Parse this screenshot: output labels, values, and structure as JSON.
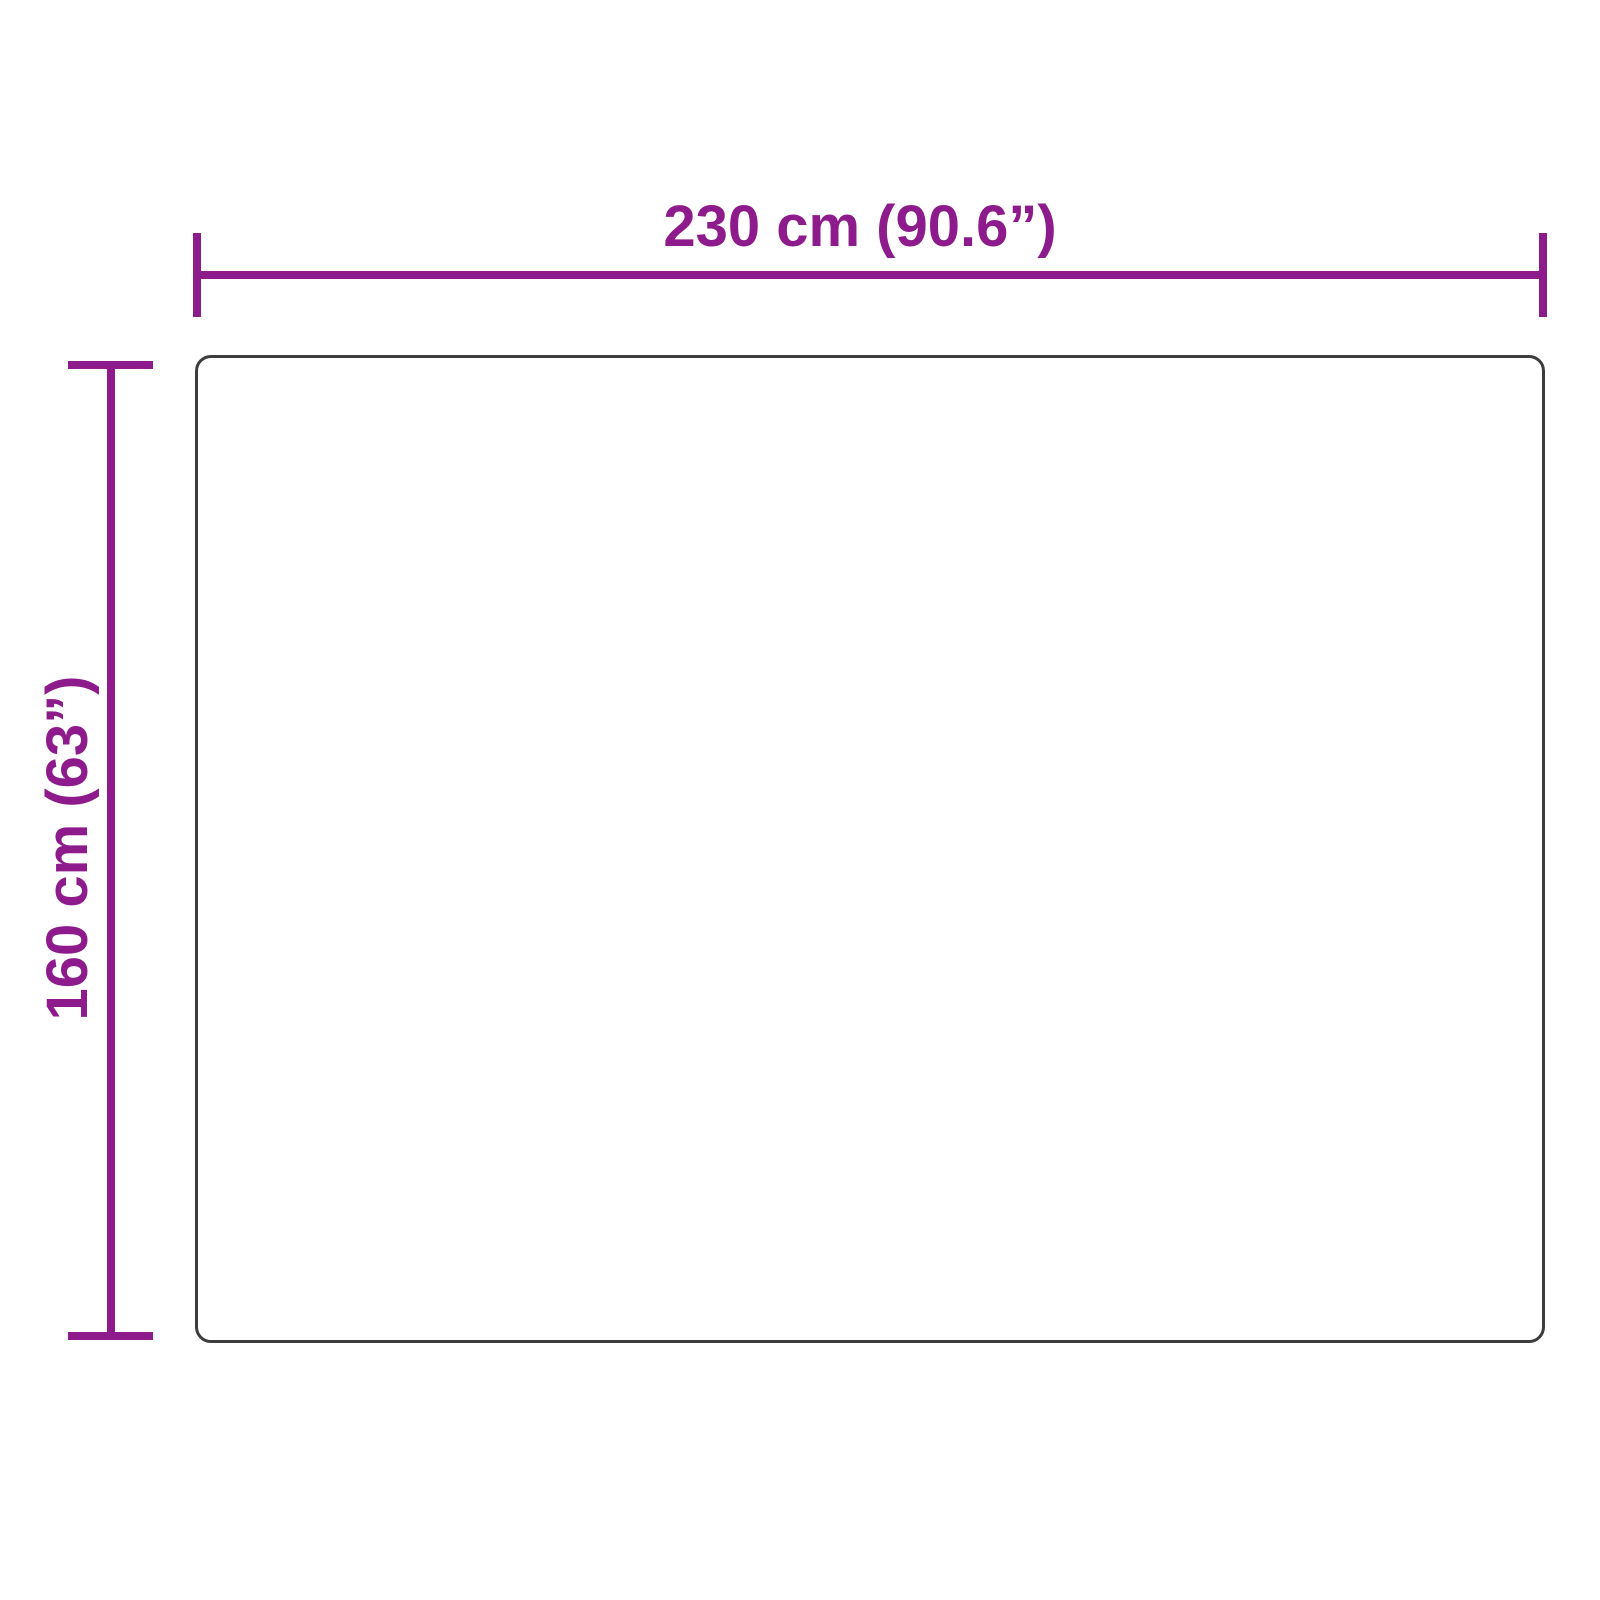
{
  "diagram": {
    "type": "product-dimension-diagram",
    "width_label": "230 cm (90.6”)",
    "height_label": "160 cm (63”)",
    "width_cm": 230,
    "width_in": 90.6,
    "height_cm": 160,
    "height_in": 63
  },
  "colors": {
    "accent": "#8E1B8B",
    "outline": "#3D3D3D",
    "background": "#FFFFFF"
  }
}
